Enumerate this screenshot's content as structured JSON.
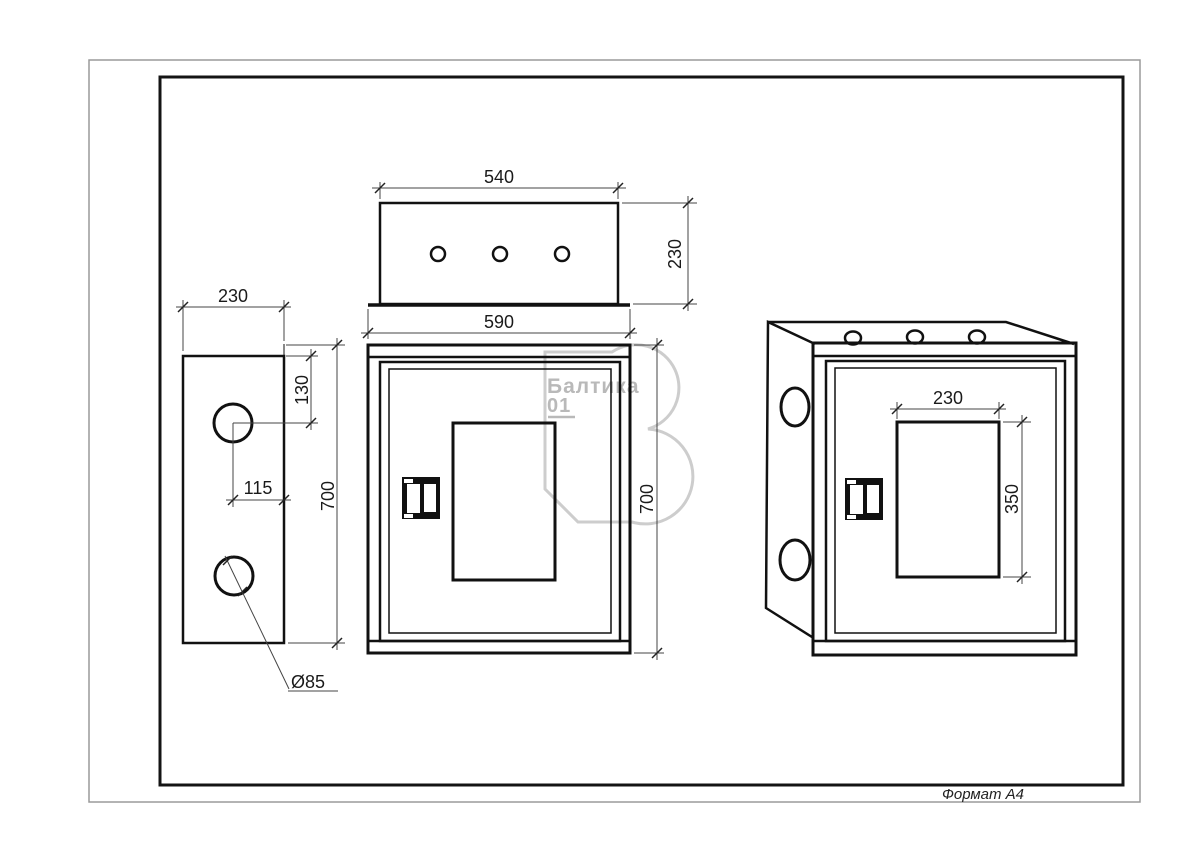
{
  "page": {
    "format_label": "Формат А4"
  },
  "watermark": {
    "brand": "Балтика",
    "number": "01"
  },
  "dims": {
    "top_width": "540",
    "top_depth": "230",
    "flange_width": "590",
    "front_height": "700",
    "side_width": "230",
    "side_height": "700",
    "side_hole_top": "130",
    "side_hole_center": "115",
    "side_hole_dia": "Ø85",
    "iso_window_width": "230",
    "iso_window_height": "350"
  }
}
